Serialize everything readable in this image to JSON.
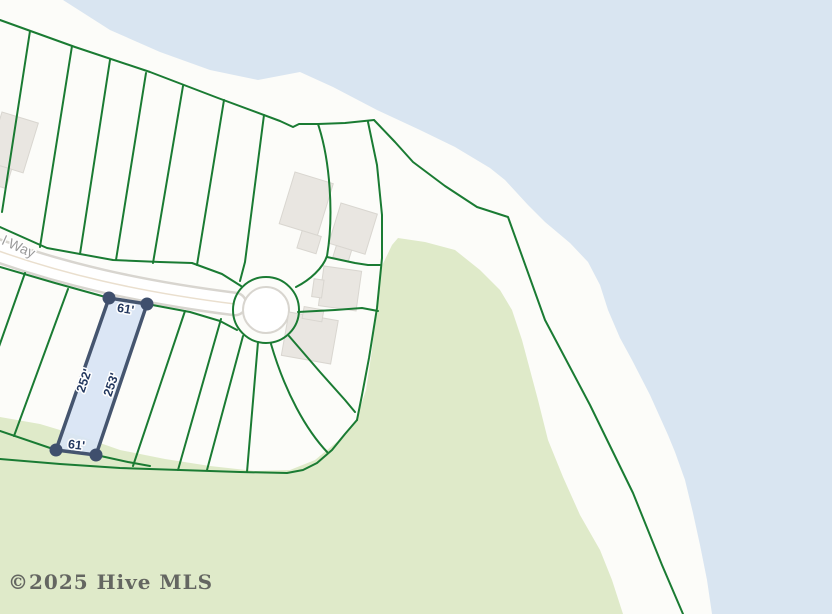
{
  "map": {
    "street_label": "l Way",
    "watermark": "©2025 Hive MLS",
    "highlighted_lot": {
      "front_width": "61'",
      "left_side": "252'",
      "right_side": "253'",
      "rear_width": "61'"
    },
    "colors": {
      "water": "#d9e5f1",
      "sand": "#fcfcf9",
      "vegetation": "#dfeac9",
      "parcel_line": "#1a7b33",
      "road_fill": "#ffffff",
      "road_casing": "#d8d5cf",
      "road_centerline": "#eadfce",
      "building": "#e9e6e1",
      "building_edge": "#d9d6d0",
      "lot_fill": "#d8e4f4",
      "lot_border": "#45556f",
      "lot_marker": "#3f4f6d",
      "dimension_text": "#22375e",
      "street_text": "#9a9a9a",
      "watermark_text": "#4f4f4f"
    }
  }
}
